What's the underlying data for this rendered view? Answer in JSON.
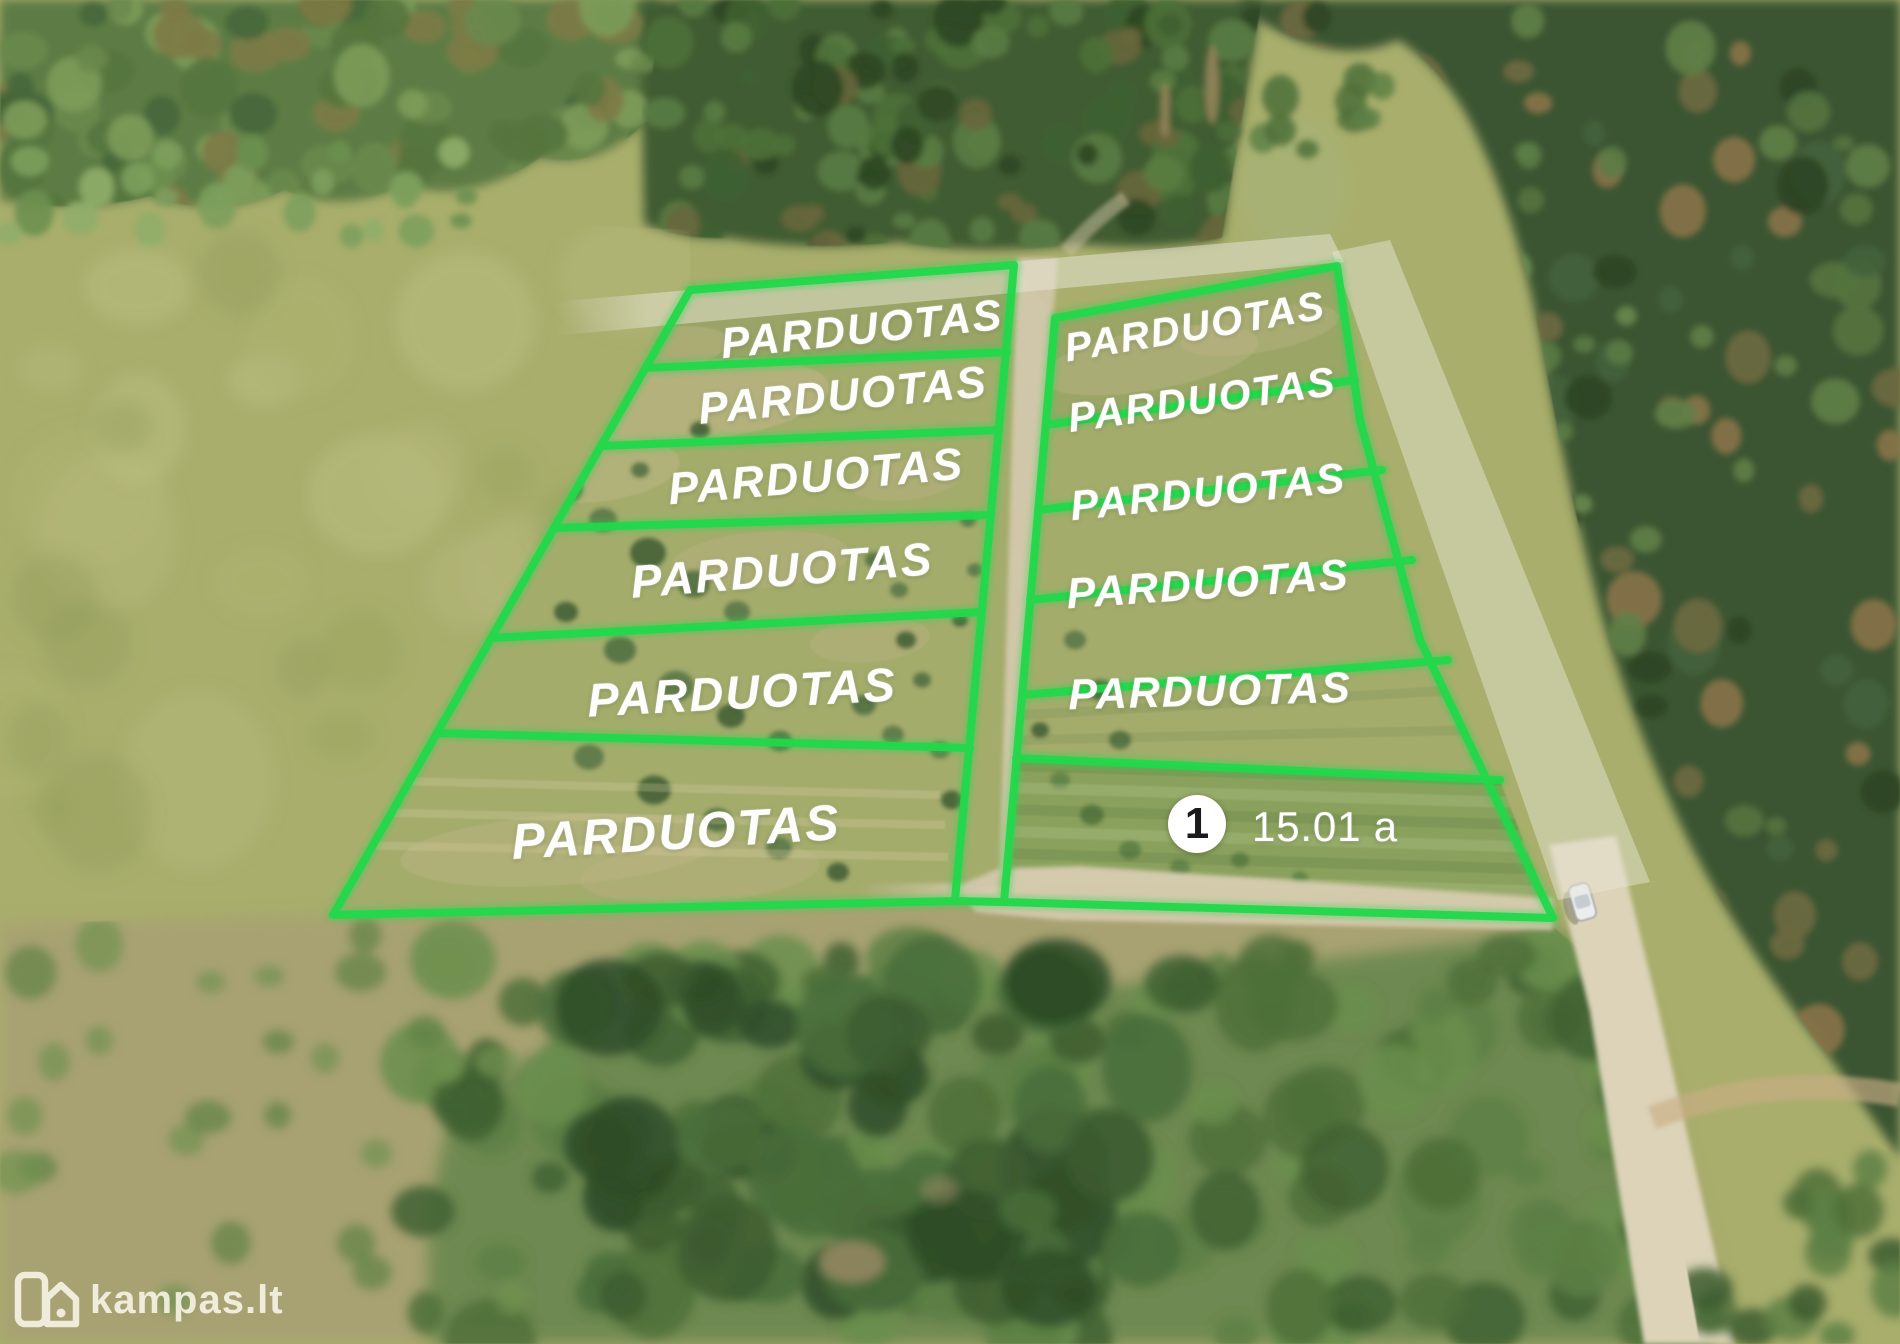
{
  "brand": {
    "name": "kampas.lt"
  },
  "listing": {
    "sold_label_text": "PARDUOTAS",
    "plots": [
      {
        "id": "left-1",
        "status": "sold",
        "label": "PARDUOTAS"
      },
      {
        "id": "left-2",
        "status": "sold",
        "label": "PARDUOTAS"
      },
      {
        "id": "left-3",
        "status": "sold",
        "label": "PARDUOTAS"
      },
      {
        "id": "left-4",
        "status": "sold",
        "label": "PARDUOTAS"
      },
      {
        "id": "left-5",
        "status": "sold",
        "label": "PARDUOTAS"
      },
      {
        "id": "left-6",
        "status": "sold",
        "label": "PARDUOTAS"
      },
      {
        "id": "right-1",
        "status": "sold",
        "label": "PARDUOTAS"
      },
      {
        "id": "right-2",
        "status": "sold",
        "label": "PARDUOTAS"
      },
      {
        "id": "right-3",
        "status": "sold",
        "label": "PARDUOTAS"
      },
      {
        "id": "right-4",
        "status": "sold",
        "label": "PARDUOTAS"
      },
      {
        "id": "right-5",
        "status": "sold",
        "label": "PARDUOTAS"
      },
      {
        "id": "plot-1",
        "status": "available",
        "number": "1",
        "area": "15.01 a"
      }
    ]
  },
  "icons": {
    "brand_logo": "house-icon"
  },
  "colors": {
    "plot_outline": "#22d74b",
    "sold_label": "#ffffff",
    "badge_background": "#ffffff",
    "badge_number": "#1b1b1b",
    "watermark": "#f5f1e3",
    "gravel_road": "#d5c9ad"
  }
}
